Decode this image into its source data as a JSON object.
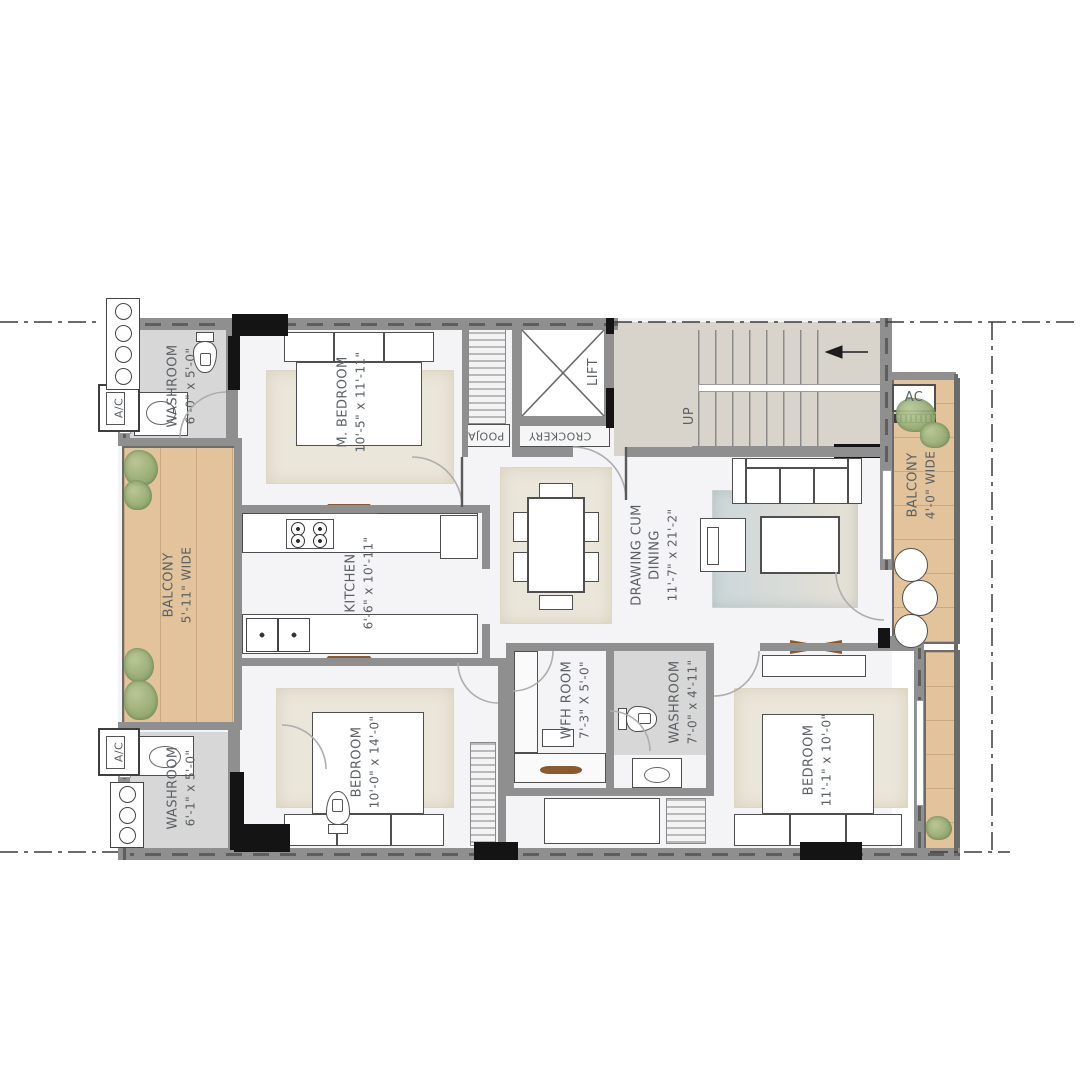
{
  "plan_labels": {
    "washroom_tl": {
      "name": "WASHROOM",
      "dims": "6'-0\" x 5'-0\""
    },
    "m_bedroom": {
      "name": "M. BEDROOM",
      "dims": "10'-5\" x 11'-11\""
    },
    "lift": {
      "name": "LIFT"
    },
    "pooja": {
      "name": "POOJA"
    },
    "crockery": {
      "name": "CROCKERY"
    },
    "up": {
      "name": "UP"
    },
    "ac_right": {
      "name": "AC"
    },
    "ac_top_left": {
      "name": "A/C"
    },
    "ac_bottom_left": {
      "name": "A/C"
    },
    "balcony_left": {
      "name": "BALCONY",
      "dims": "5'-11\" WIDE"
    },
    "balcony_right": {
      "name": "BALCONY",
      "dims": "4'-0\" WIDE"
    },
    "kitchen": {
      "name": "KITCHEN",
      "dims": "6'-6\" x 10'-11\""
    },
    "drawing_dining": {
      "line1": "DRAWING CUM",
      "line2": "DINING",
      "dims": "11'-7\" x 21'-2\""
    },
    "wfh": {
      "name": "WFH ROOM",
      "dims": "7'-3\" X 5'-0\""
    },
    "washroom_center": {
      "name": "WASHROOM",
      "dims": "7'-0\" x 4'-11\""
    },
    "bedroom_bl": {
      "name": "BEDROOM",
      "dims": "10'-0\" x 14'-0\""
    },
    "bedroom_br": {
      "name": "BEDROOM",
      "dims": "11'-1\" x 10'-0\""
    },
    "washroom_bl": {
      "name": "WASHROOM",
      "dims": "6'-1\" x 5'-0\""
    }
  },
  "colors": {
    "wall": "#8f8f8f",
    "column": "#141414",
    "wood": "#e2c39c",
    "washroom_floor": "#d7d7d7",
    "concrete": "#d8d4cb",
    "rug_beige": "#ebe6da",
    "rug_blue": "#ccd7da",
    "greenery": "#8ea568",
    "label_text": "#5a6064"
  }
}
